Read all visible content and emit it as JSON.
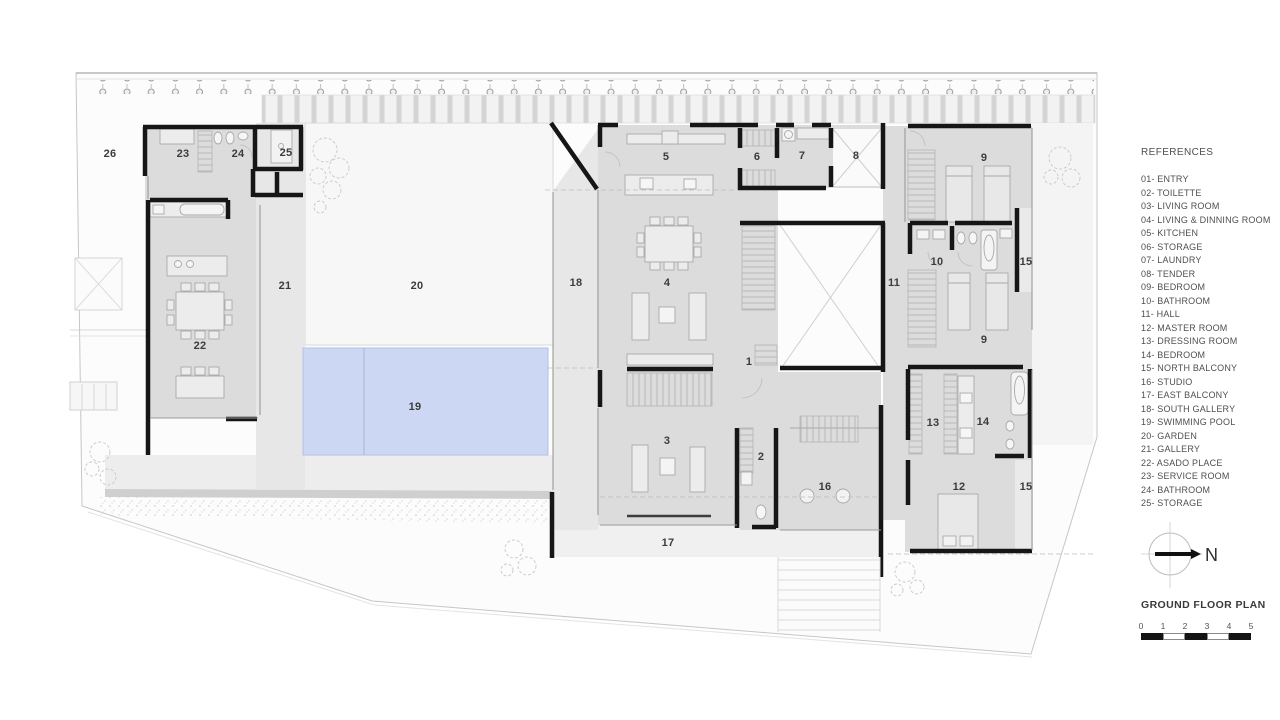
{
  "legend": {
    "title": "REFERENCES",
    "items": [
      "01- ENTRY",
      "02- TOILETTE",
      "03- LIVING ROOM",
      "04- LIVING & DINNING ROOM",
      "05- KITCHEN",
      "06- STORAGE",
      "07- LAUNDRY",
      "08- TENDER",
      "09- BEDROOM",
      "10- BATHROOM",
      "11- HALL",
      "12- MASTER ROOM",
      "13- DRESSING ROOM",
      "14- BEDROOM",
      "15- NORTH BALCONY",
      "16- STUDIO",
      "17- EAST BALCONY",
      "18- SOUTH GALLERY",
      "19- SWIMMING POOL",
      "20- GARDEN",
      "21- GALLERY",
      "22- ASADO PLACE",
      "23- SERVICE ROOM",
      "24- BATHROOM",
      "25- STORAGE"
    ],
    "north_label": "N",
    "plan_title": "GROUND FLOOR PLAN",
    "scale_numbers": [
      "0",
      "1",
      "2",
      "3",
      "4",
      "5"
    ]
  },
  "plan": {
    "room_labels": [
      {
        "label": "26",
        "x": 110,
        "y": 154
      },
      {
        "label": "23",
        "x": 183,
        "y": 154
      },
      {
        "label": "24",
        "x": 238,
        "y": 154
      },
      {
        "label": "25",
        "x": 286,
        "y": 153
      },
      {
        "label": "5",
        "x": 666,
        "y": 157
      },
      {
        "label": "6",
        "x": 757,
        "y": 157
      },
      {
        "label": "7",
        "x": 802,
        "y": 156
      },
      {
        "label": "8",
        "x": 856,
        "y": 156
      },
      {
        "label": "9",
        "x": 984,
        "y": 158
      },
      {
        "label": "10",
        "x": 937,
        "y": 262
      },
      {
        "label": "15",
        "x": 1026,
        "y": 262
      },
      {
        "label": "18",
        "x": 576,
        "y": 283
      },
      {
        "label": "4",
        "x": 667,
        "y": 283
      },
      {
        "label": "11",
        "x": 894,
        "y": 283
      },
      {
        "label": "21",
        "x": 285,
        "y": 286
      },
      {
        "label": "20",
        "x": 417,
        "y": 286
      },
      {
        "label": "9",
        "x": 984,
        "y": 340
      },
      {
        "label": "22",
        "x": 200,
        "y": 346
      },
      {
        "label": "1",
        "x": 749,
        "y": 362
      },
      {
        "label": "19",
        "x": 415,
        "y": 407
      },
      {
        "label": "13",
        "x": 933,
        "y": 423
      },
      {
        "label": "14",
        "x": 983,
        "y": 422
      },
      {
        "label": "3",
        "x": 667,
        "y": 441
      },
      {
        "label": "2",
        "x": 761,
        "y": 457
      },
      {
        "label": "16",
        "x": 825,
        "y": 487
      },
      {
        "label": "12",
        "x": 959,
        "y": 487
      },
      {
        "label": "15",
        "x": 1026,
        "y": 487
      },
      {
        "label": "17",
        "x": 668,
        "y": 543
      }
    ]
  },
  "colors": {
    "pool": "#cbd7f3",
    "wall": "#161616",
    "room_fill": "#dcdcdc",
    "label_text": "#3c3c3c"
  }
}
